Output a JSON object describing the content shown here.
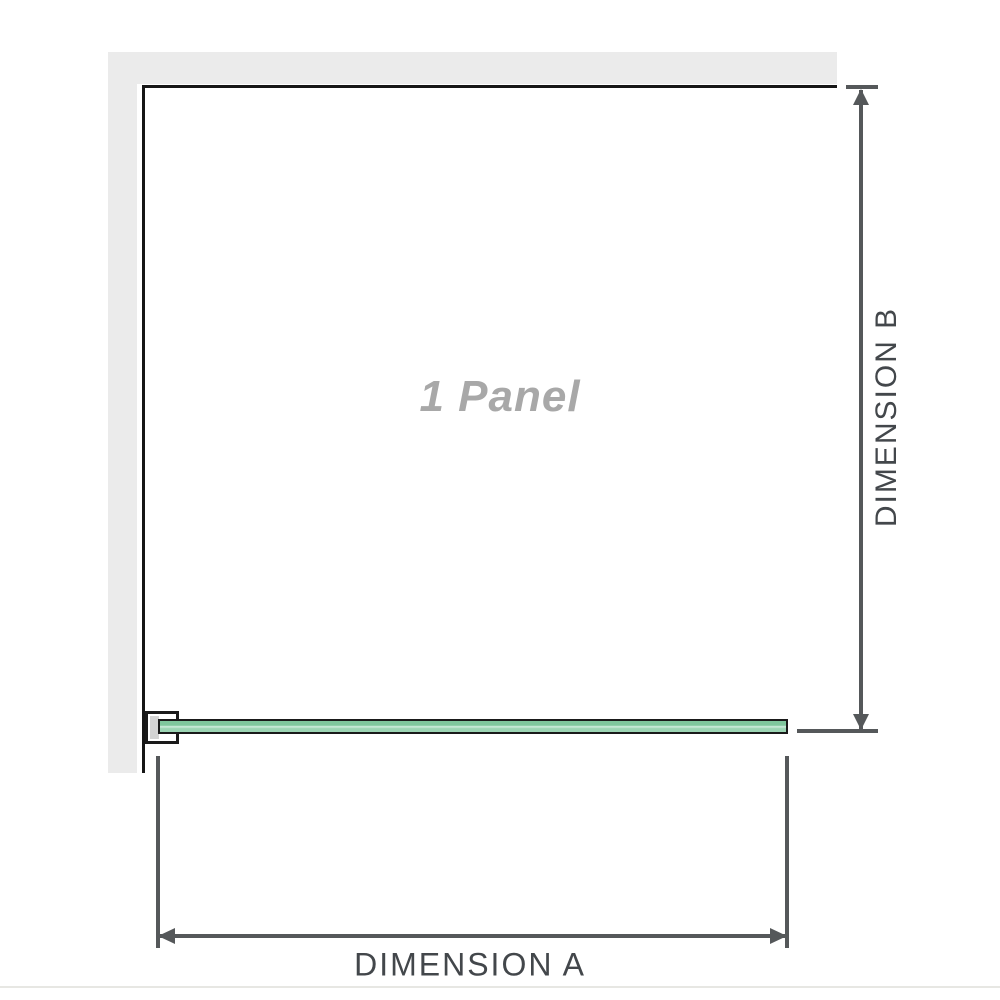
{
  "diagram": {
    "panel_label": "1 Panel",
    "dimension_a": {
      "label": "DIMENSION A"
    },
    "dimension_b": {
      "label": "DIMENSION B"
    }
  },
  "colors": {
    "page_bg": "#ffffff",
    "wall_fill": "#ebebeb",
    "wall_edge": "#161616",
    "glass_border": "#1a1a1a",
    "glass_green_dark": "#7fc79d",
    "glass_green_light": "#d2efe0",
    "glass_green_mid": "#9cd5b4",
    "clamp_fill": "#d3d3d3",
    "dimension_line": "#55585a",
    "dimension_text": "#43474b",
    "panel_label_text": "#a8a8a8",
    "baseline_rule": "#e7e7e3"
  }
}
